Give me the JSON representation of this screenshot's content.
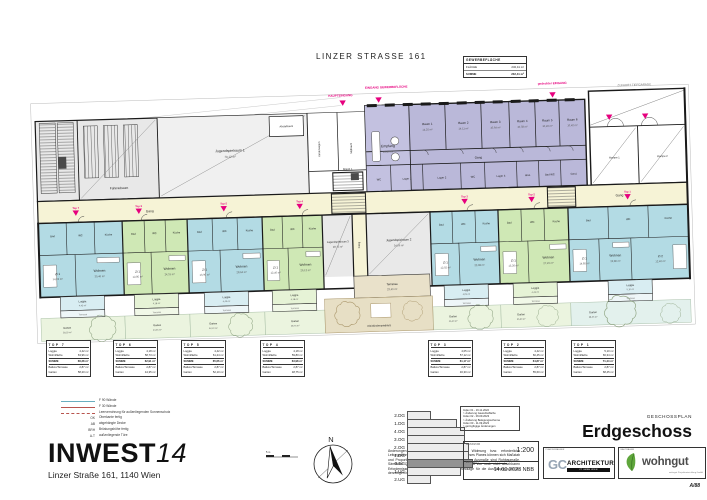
{
  "title": "LINZER STRASSE 161",
  "gewerbe_table": {
    "header": "GEWERBEFLÄCHE",
    "rows": [
      {
        "label": "FLÄCHE",
        "value": "232,41 m²"
      },
      {
        "label": "SUMME",
        "value": "232,41 m²"
      }
    ]
  },
  "plan": {
    "entrances": {
      "main": "HAUPTEINGANG",
      "commercial": "EINGANG GEWERBEFLÄCHE",
      "covered": "gedeckter EINGANG",
      "garage": "ZUFAHRT TIEFGARAGE"
    },
    "communal": {
      "bike": "Fahrradraum",
      "youth1": "Jugendspielraum 1",
      "youth1_area": "70,12 m²",
      "youth2": "Jugendspielraum 2",
      "youth2_area": "34,96 m²",
      "youth3": "Jugendspielraum 3",
      "youth3_area": "28,73 m²",
      "stroller": "Kinderwagen",
      "waste": "Müllraum",
      "stair1": "Stiege 1",
      "stair2": "Stiege 2",
      "abstell": "Abstellraum",
      "terrace": "Terrasse",
      "terrace_area": "23,40 m²",
      "playground": "Kleinkinderspielplatz",
      "playground_area": "93,60 m²"
    },
    "gewerbe": {
      "reception": "Empfang",
      "reception_area": "12,40 m²",
      "corridor": "Gang",
      "rooms": [
        {
          "name": "Raum 1",
          "area": "14,25 m²"
        },
        {
          "name": "Raum 2",
          "area": "14,11 m²"
        },
        {
          "name": "Raum 3",
          "area": "10,64 m²"
        },
        {
          "name": "Raum 4",
          "area": "10,58 m²"
        },
        {
          "name": "Raum 5",
          "area": "10,49 m²"
        },
        {
          "name": "Raum 6",
          "area": "10,42 m²"
        }
      ],
      "back": [
        "WC",
        "Lager 1",
        "Lager 2",
        "WC",
        "Lager 3",
        "Abst.",
        "Bad WC",
        "Gard."
      ]
    },
    "ramp": {
      "r1": "Rampe 1",
      "r2": "Rampe 2"
    },
    "corridor_label": "Gang",
    "passage_label": "Gang",
    "markers": [
      "Top 7",
      "Top 6",
      "Top 5",
      "Top 4",
      "Top 3",
      "Top 2",
      "Top 1"
    ],
    "units": [
      {
        "living": "Wohnen",
        "living_area": "30,46 m²",
        "room1": "Zi 1",
        "room1_area": "14,02 m²",
        "bath": "Bad",
        "wc": "WC",
        "kitchen": "Küche",
        "loggia": "Loggia",
        "loggia_area": "4,42 m²",
        "terrace": "Terrasse",
        "garden": "Garten",
        "garden_area": "58,20 m²"
      },
      {
        "living": "Wohnen",
        "living_area": "24,31 m²",
        "room1": "Zi 1",
        "room1_area": "12,85 m²",
        "bath": "Bad",
        "wc": "WC",
        "kitchen": "Küche",
        "loggia": "Loggia",
        "loggia_area": "4,18 m²",
        "terrace": "Terrasse",
        "garden": "Garten",
        "garden_area": "44,35 m²"
      },
      {
        "living": "Wohnen",
        "living_area": "28,64 m²",
        "room1": "Zi 1",
        "room1_area": "13,90 m²",
        "bath": "Bad",
        "wc": "WC",
        "kitchen": "Küche",
        "loggia": "Loggia",
        "loggia_area": "4,42 m²",
        "terrace": "Terrasse",
        "garden": "Garten",
        "garden_area": "52,10 m²"
      },
      {
        "living": "Wohnen",
        "living_area": "26,12 m²",
        "room1": "Zi 1",
        "room1_area": "12,40 m²",
        "bath": "Bad",
        "wc": "WC",
        "kitchen": "Küche",
        "loggia": "Loggia",
        "loggia_area": "4,18 m²",
        "terrace": "Terrasse",
        "garden": "Garten",
        "garden_area": "48,75 m²"
      },
      {
        "living": "Wohnen",
        "living_area": "23,98 m²",
        "room1": "Zi 1",
        "room1_area": "12,02 m²",
        "bath": "Bad",
        "wc": "WC",
        "kitchen": "Küche",
        "loggia": "Loggia",
        "loggia_area": "4,05 m²",
        "terrace": "Terrasse",
        "garden": "Garten",
        "garden_area": "46,30 m²"
      },
      {
        "living": "Wohnen",
        "living_area": "27,45 m²",
        "room1": "Zi 1",
        "room1_area": "13,26 m²",
        "bath": "Bad",
        "wc": "WC",
        "kitchen": "Küche",
        "loggia": "Loggia",
        "loggia_area": "4,42 m²",
        "terrace": "Terrasse",
        "garden": "Garten",
        "garden_area": "55,60 m²"
      },
      {
        "living": "Wohnen",
        "living_area": "32,80 m²",
        "room1": "Zi 1",
        "room1_area": "14,85 m²",
        "room2": "Zi 2",
        "room2_area": "12,40 m²",
        "bath": "Bad",
        "wc": "WC",
        "kitchen": "Küche",
        "loggia": "Loggia",
        "loggia_area": "5,10 m²",
        "terrace": "Terrasse",
        "garden": "Garten",
        "garden_area": "68,45 m²"
      }
    ]
  },
  "top_tables": [
    {
      "title": "TOP 7",
      "rows": [
        [
          "Loggia",
          "4,42 m²"
        ],
        [
          "Wohnfläche",
          "63,96 m²"
        ],
        [
          "SUMME",
          "68,38 m²"
        ],
        [
          "Balkon/Terrasse",
          "2,87 m²"
        ],
        [
          "Garten",
          "58,20 m²"
        ]
      ]
    },
    {
      "title": "TOP 6",
      "rows": [
        [
          "Loggia",
          "4,18 m²"
        ],
        [
          "Wohnfläche",
          "58,73 m²"
        ],
        [
          "SUMME",
          "62,91 m²"
        ],
        [
          "Balkon/Terrasse",
          "2,87 m²"
        ],
        [
          "Garten",
          "44,35 m²"
        ]
      ]
    },
    {
      "title": "TOP 5",
      "rows": [
        [
          "Loggia",
          "4,42 m²"
        ],
        [
          "Wohnfläche",
          "61,24 m²"
        ],
        [
          "SUMME",
          "65,66 m²"
        ],
        [
          "Balkon/Terrasse",
          "2,87 m²"
        ],
        [
          "Garten",
          "52,10 m²"
        ]
      ]
    },
    {
      "title": "TOP 4",
      "rows": [
        [
          "Loggia",
          "4,18 m²"
        ],
        [
          "Wohnfläche",
          "59,80 m²"
        ],
        [
          "SUMME",
          "63,98 m²"
        ],
        [
          "Balkon/Terrasse",
          "2,87 m²"
        ],
        [
          "Garten",
          "48,75 m²"
        ]
      ]
    },
    {
      "title": "TOP 3",
      "rows": [
        [
          "Loggia",
          "4,05 m²"
        ],
        [
          "Wohnfläche",
          "57,12 m²"
        ],
        [
          "SUMME",
          "61,17 m²"
        ],
        [
          "Balkon/Terrasse",
          "2,87 m²"
        ],
        [
          "Garten",
          "46,30 m²"
        ]
      ]
    },
    {
      "title": "TOP 2",
      "rows": [
        [
          "Loggia",
          "4,42 m²"
        ],
        [
          "Wohnfläche",
          "60,45 m²"
        ],
        [
          "SUMME",
          "64,87 m²"
        ],
        [
          "Balkon/Terrasse",
          "2,87 m²"
        ],
        [
          "Garten",
          "55,60 m²"
        ]
      ]
    },
    {
      "title": "TOP 1",
      "rows": [
        [
          "Loggia",
          "5,10 m²"
        ],
        [
          "Wohnfläche",
          "66,34 m²"
        ],
        [
          "SUMME",
          "71,44 m²"
        ],
        [
          "Balkon/Terrasse",
          "2,87 m²"
        ],
        [
          "Garten",
          "68,45 m²"
        ]
      ]
    }
  ],
  "legend": [
    {
      "abbr": "",
      "label": "F 90 Wände"
    },
    {
      "abbr": "",
      "label": "F 30 Wände"
    },
    {
      "abbr": "",
      "label": "Leerverrohrung für außenliegenden Sonnenschutz"
    },
    {
      "abbr": "OK",
      "label": "Oberkante fertig"
    },
    {
      "abbr": "AB",
      "label": "abgehängte Decke"
    },
    {
      "abbr": "BRH",
      "label": "Brüstungshöhe fertig"
    },
    {
      "abbr": "A-T",
      "label": "außenliegende Türe"
    }
  ],
  "project": {
    "name": "INWEST",
    "suffix": "14",
    "address": "Linzer Straße 161, 1140 Wien"
  },
  "disclaimer": "Änderungen vorbehalten (z.B. Änderung der Widmung bzw. erforderliche Leitungsführungen etc.). Achtung: Durch Kopieren dieses Planes können sich Maßstab und Proportion verändern! Die im Plan angegebenen Ausmaße sind Rohbaumaße. Sämtliche Quadratmeterangaben können sich aufgrund von noch nicht absehbaren Erfordernissen noch geringfügig verändern. Grundlage für die Ausführung sind die derzeitigen behördlichen Bestimmungen.",
  "floor_index": {
    "floors": [
      "2.DG",
      "1.DG",
      "4.OG",
      "3.OG",
      "2.OG",
      "1.OG",
      "0.EG",
      "1.UG",
      "2.UG"
    ]
  },
  "revisions": [
    "Index 01 - 16.11.2022",
    "> Änderung Gewerbefläche",
    "Index 02 - 06.09.2023",
    "> Änderung Belegungsschema",
    "Index 03 - 11.09.2023",
    "> geringfügige Änderungen"
  ],
  "scale_box": {
    "label": "MASSSTAB",
    "value": "1:200"
  },
  "date_box": {
    "label": "ERSTELLT",
    "value": "14.09.2023 NBB"
  },
  "titleblock": {
    "type_label": "GESCHOSSPLAN",
    "title": "Erdgeschoss",
    "planner_label": "PLANVERFASSER",
    "client_label": "BAUTRÄGER",
    "gc": "GC",
    "gc2": "ARCHITEKTUR",
    "gc3": "ZT GMBH WIEN",
    "wohngut": "wohngut",
    "wohngut_caption": "wohngut Projektentwicklung GmbH",
    "plan_no": "A/88"
  },
  "compass_label": "N",
  "scalebar_label": "5 m"
}
